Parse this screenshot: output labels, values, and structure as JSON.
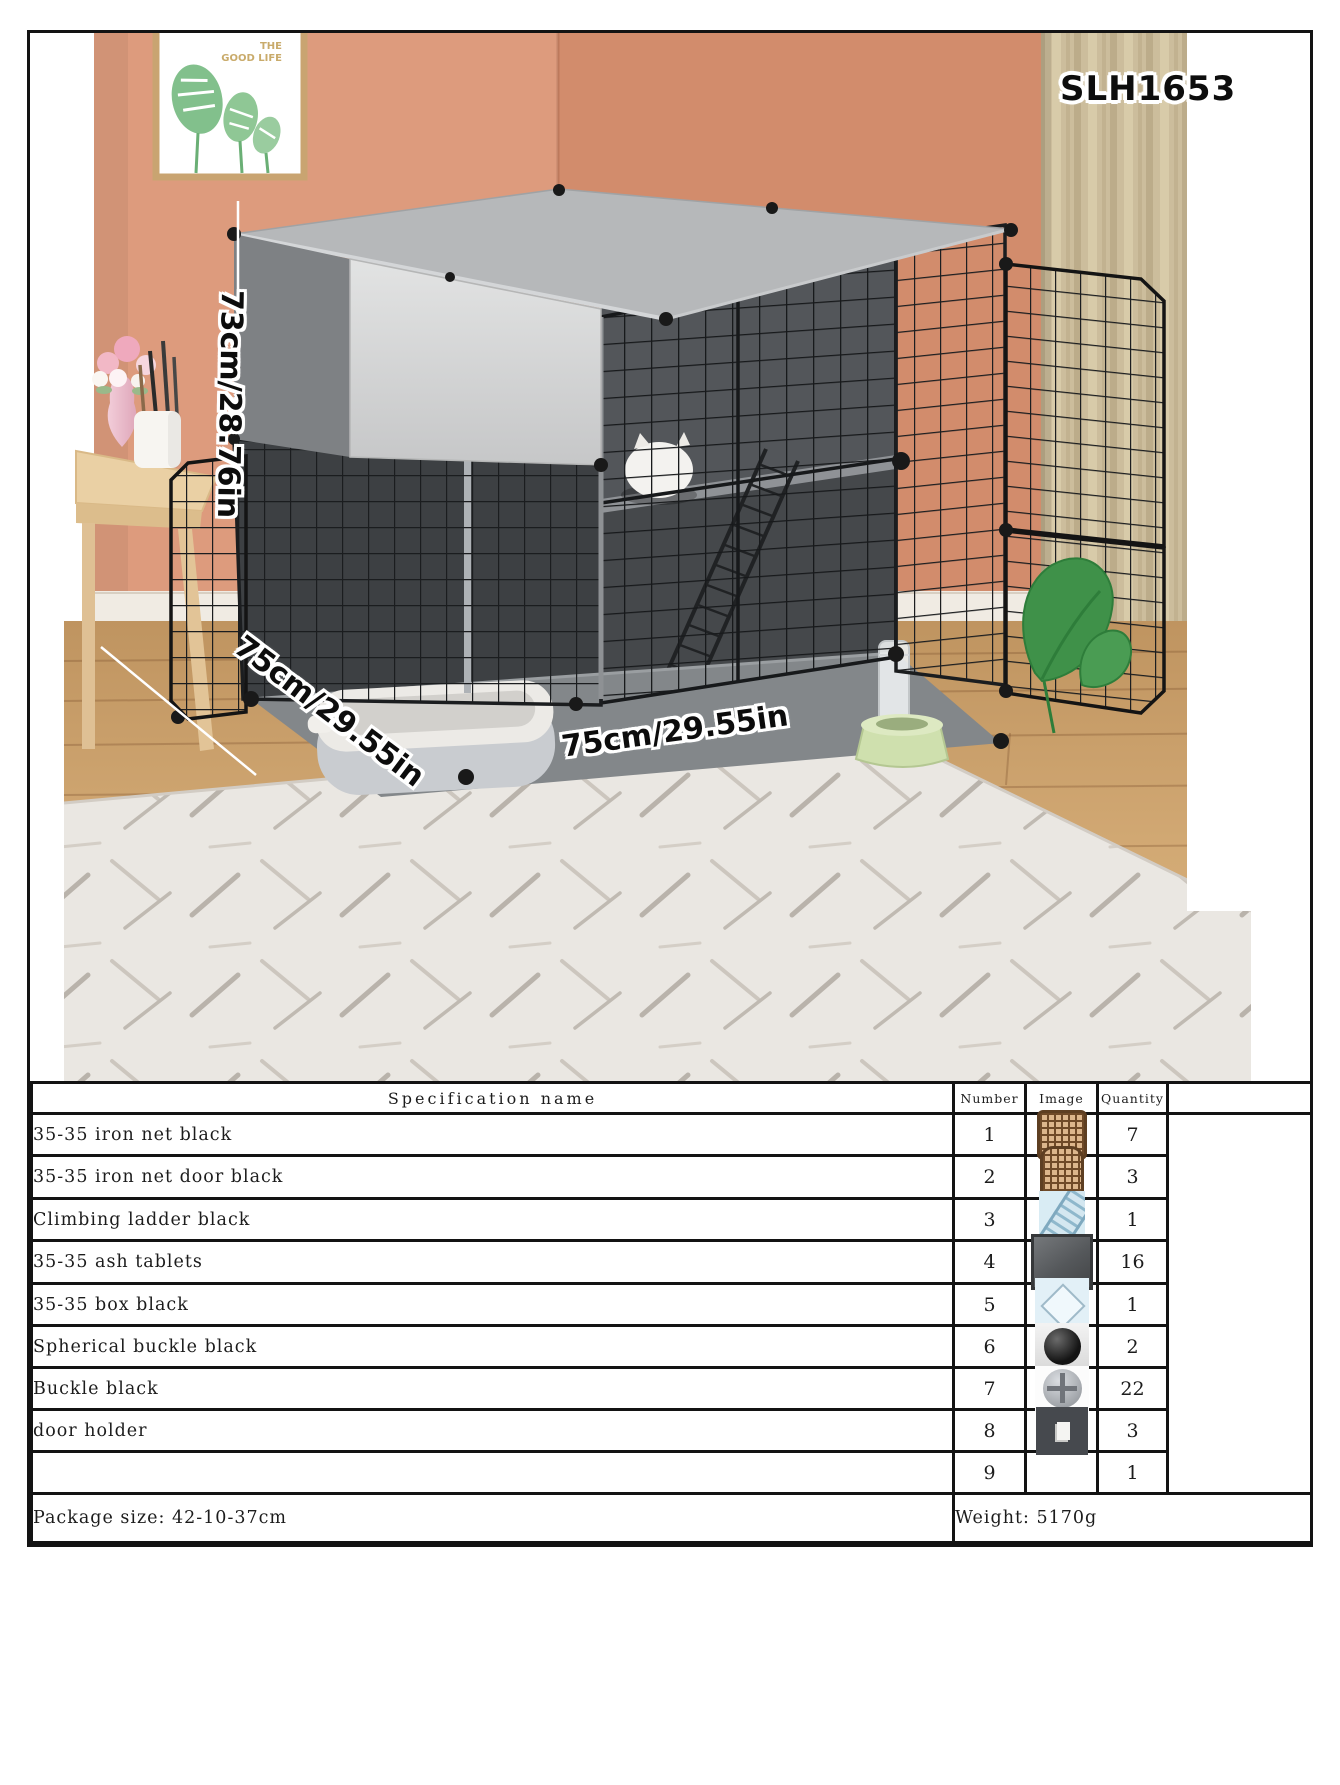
{
  "product": {
    "model": "SLH1653",
    "dimensions": {
      "height_label": "73cm/28.76in",
      "width_label": "75cm/29.55in",
      "depth_label": "75cm/29.55in"
    }
  },
  "photo": {
    "frame_caption_line1": "THE",
    "frame_caption_line2": "GOOD LIFE",
    "scene_items": [
      "framed-leaf-picture",
      "curtain",
      "side-table",
      "flower-vase",
      "pen-cup",
      "pet-cage",
      "litter-box",
      "water-bottle",
      "pet-bowl",
      "climbing-ladder",
      "white-cat",
      "rug",
      "monstera-leaf"
    ]
  },
  "spec_table": {
    "headers": {
      "name": "Specification name",
      "number": "Number",
      "image": "Image",
      "quantity": "Quantity"
    },
    "rows": [
      {
        "name": "35-35 iron net black",
        "number": "1",
        "image": "iron-net",
        "quantity": "7"
      },
      {
        "name": "35-35 iron net door black",
        "number": "2",
        "image": "iron-net-door",
        "quantity": "3"
      },
      {
        "name": "Climbing ladder black",
        "number": "3",
        "image": "climbing-ladder",
        "quantity": "1"
      },
      {
        "name": "35-35 ash tablets",
        "number": "4",
        "image": "ash-tablet",
        "quantity": "16"
      },
      {
        "name": "35-35 box black",
        "number": "5",
        "image": "box",
        "quantity": "1"
      },
      {
        "name": "Spherical buckle black",
        "number": "6",
        "image": "spherical-buckle",
        "quantity": "2"
      },
      {
        "name": "Buckle black",
        "number": "7",
        "image": "buckle",
        "quantity": "22"
      },
      {
        "name": "door holder",
        "number": "8",
        "image": "door-holder",
        "quantity": "3"
      },
      {
        "name": "",
        "number": "9",
        "image": "",
        "quantity": "1"
      }
    ],
    "footer": {
      "package_size": "Package size: 42-10-37cm",
      "weight": "Weight: 5170g"
    }
  },
  "colors": {
    "wall_left": "#dd9b7d",
    "wall_right": "#d28c6c",
    "curtain": "#cbbc9b",
    "floor_wood": "#cda26e",
    "rug": "#eae7e2",
    "cage_mesh": "#1b1d1f",
    "cage_panel_gray": "#b6b8ba",
    "bowl_green": "#cfe0ae",
    "table_border": "#131313"
  }
}
